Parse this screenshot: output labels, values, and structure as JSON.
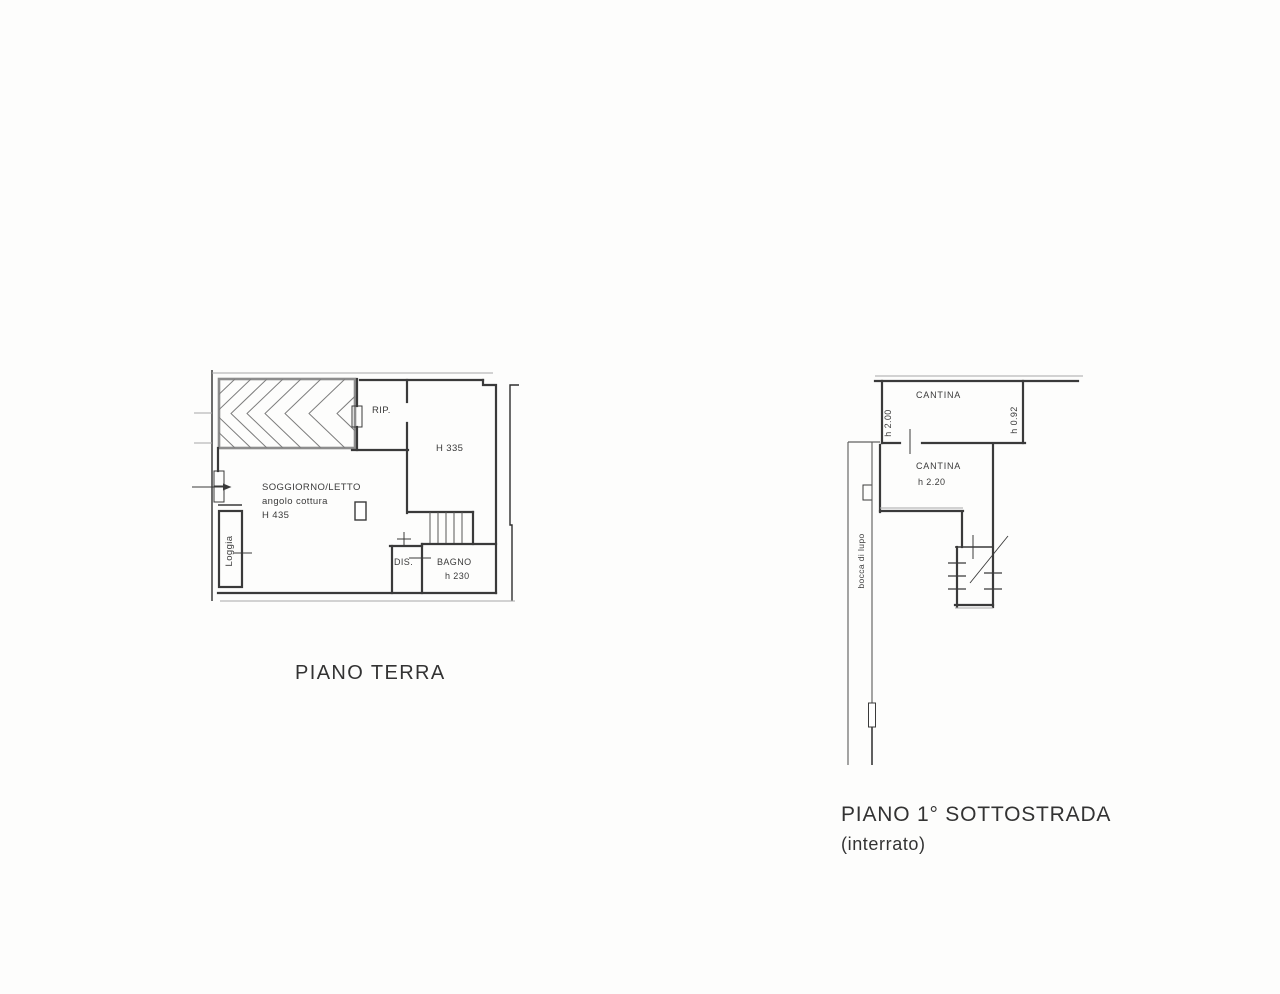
{
  "document": {
    "type": "floor-plan-drawing",
    "background": "#fdfdfc",
    "line_color": "#3a3a3a",
    "line_color_light": "#a8a8a8",
    "text_color": "#3a3a3a"
  },
  "ground_floor": {
    "title": "PIANO TERRA",
    "labels": {
      "rip": "RIP.",
      "h335": "H 335",
      "soggiorno_line1": "SOGGIORNO/LETTO",
      "soggiorno_line2": "angolo cottura",
      "soggiorno_line3": "H 435",
      "loggia": "Loggia",
      "dis": "DIS.",
      "bagno": "BAGNO",
      "bagno_h": "h 230"
    }
  },
  "basement": {
    "title": "PIANO 1° SOTTOSTRADA",
    "subtitle": "(interrato)",
    "labels": {
      "cantina_top": "CANTINA",
      "cantina_top_h_left": "h 2.00",
      "cantina_top_h_right": "h 0.92",
      "cantina_lower": "CANTINA",
      "cantina_lower_h": "h 2.20",
      "bocca_di_lupo": "bocca di lupo"
    }
  }
}
